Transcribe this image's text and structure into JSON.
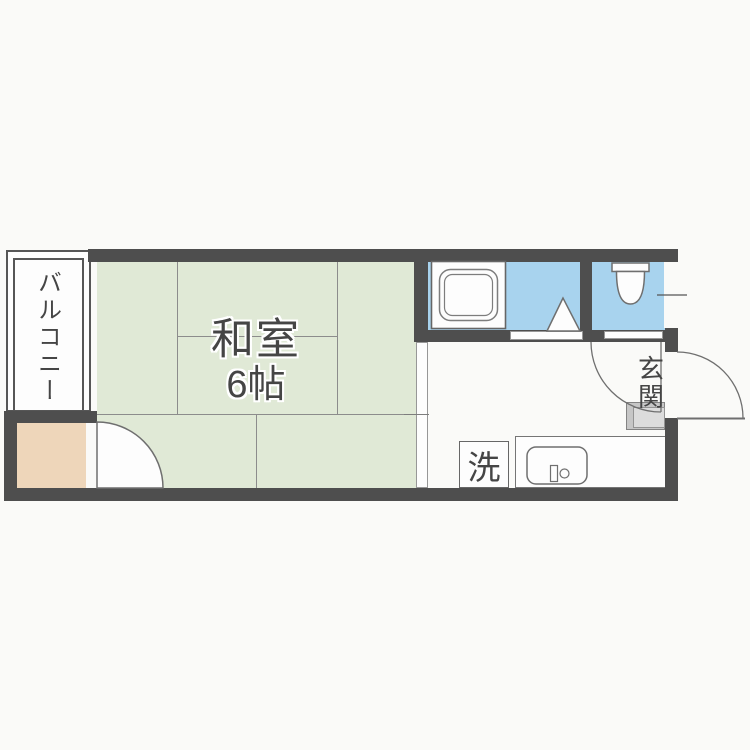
{
  "floorplan": {
    "rooms": {
      "tatami": {
        "name": "和室",
        "size": "6帖"
      },
      "balcony": {
        "label": "バルコニー"
      },
      "entrance": {
        "label": "玄関"
      },
      "laundry": {
        "label": "洗"
      }
    },
    "icons": {
      "bathtub": "bathtub-icon",
      "toilet": "toilet-icon",
      "kitchen_sink": "kitchen-sink-icon",
      "folding_bath_door": "folding-door-icon",
      "swing_doors": "door-swing-arc-icon",
      "window_tick": "window-icon"
    },
    "colors": {
      "wall": "#4e4e4e",
      "tatami_floor": "#e0e9d6",
      "wet_area_floor": "#a8d3ee",
      "closet_floor": "#eed6ba",
      "entrance_step": "#c6c6c6",
      "line": "#8c8c8c",
      "text": "#454545",
      "background": "#fafaf8"
    }
  }
}
